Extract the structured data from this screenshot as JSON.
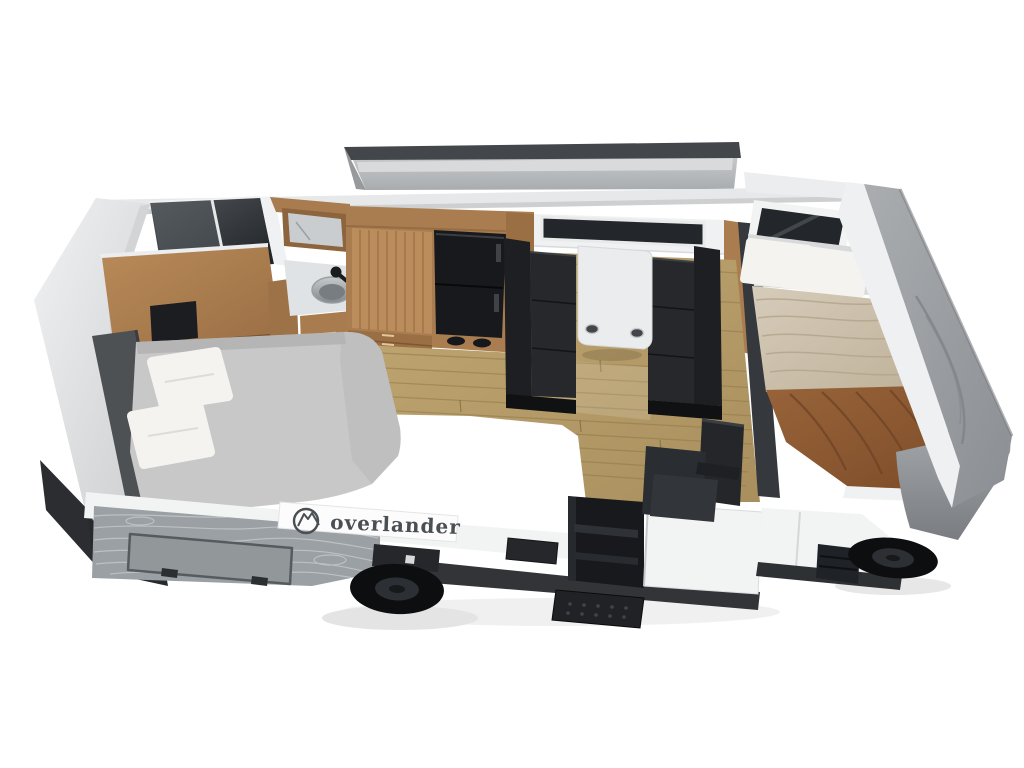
{
  "brand": {
    "logo_text": "overlander",
    "logo_icon": "mountain-circle-icon"
  },
  "colors": {
    "background": "#ffffff",
    "roof_edge": "#43464a",
    "wall_band": "#e7e8ea",
    "wood": "#aa7d50",
    "wood_dark": "#8c643d",
    "wood_light": "#c09467",
    "floor_line": "#8f7a49",
    "seat_black": "#26282b",
    "fridge_black": "#17191c",
    "pillow_white": "#f4f3f0",
    "bolster_gray": "#4e5154",
    "table_white": "#ebeced",
    "window_dark": "#23262a",
    "wall_white": "#f0f1f2",
    "counter_white": "#eef0f0",
    "cooktop_black": "#111317",
    "faucet_black": "#1a1c1e",
    "body_white": "#f2f3f3",
    "topo_gray": "#9aa0a3",
    "topo_line": "#c3c7c9",
    "skirt_dark": "#323437",
    "wheel_black": "#0d0e0f",
    "step_black": "#1f2124",
    "logo_text": "#4a4f53",
    "blanket_brown": "#8a5732",
    "quilt_beige": "#cec3af",
    "mattress_gray": "#c7c8c7"
  }
}
